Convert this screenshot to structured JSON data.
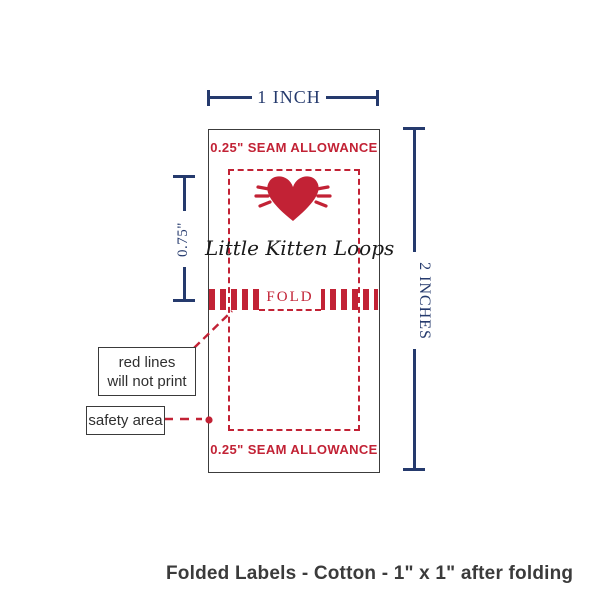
{
  "colors": {
    "navy": "#253a6d",
    "red": "#c22235",
    "ink": "#3b3b3b",
    "outline": "#3c3c3c",
    "background": "#ffffff"
  },
  "dimensions": {
    "top": {
      "label": "1 INCH"
    },
    "right": {
      "label": "2 INCHES"
    },
    "left": {
      "label": "0.75\""
    }
  },
  "label_template": {
    "seam_allowance_top": "0.25\" SEAM ALLOWANCE",
    "seam_allowance_bottom": "0.25\" SEAM ALLOWANCE",
    "brand_text": "Little Kitten Loops",
    "fold_label": "FOLD",
    "icon": "heart-with-rays-icon"
  },
  "callouts": {
    "red_lines": {
      "line1": "red lines",
      "line2": "will not print"
    },
    "safety": {
      "label": "safety area"
    }
  },
  "caption": "Folded Labels - Cotton - 1\" x 1\" after folding"
}
